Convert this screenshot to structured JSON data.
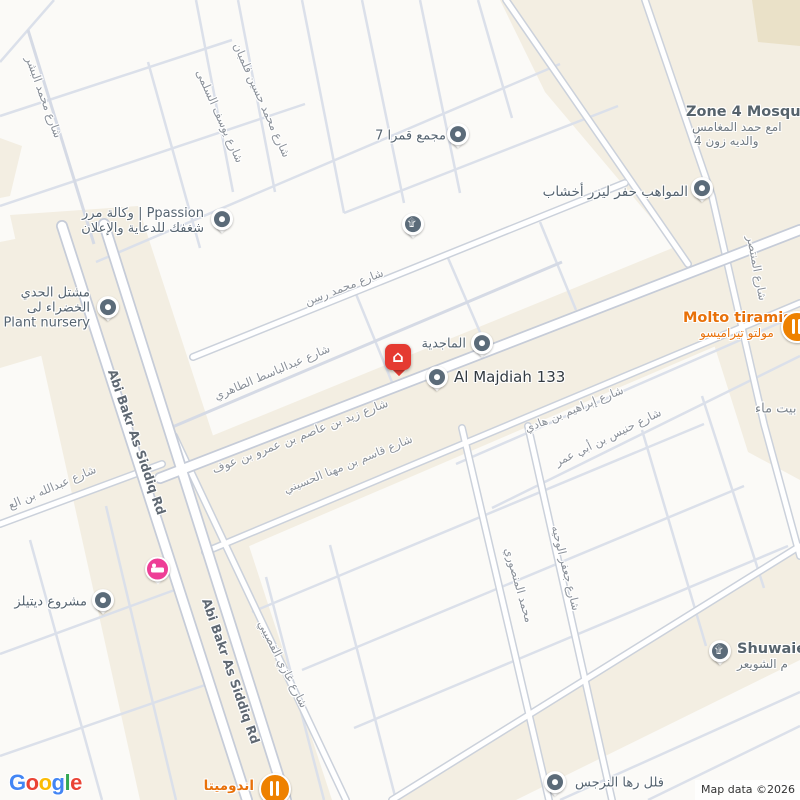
{
  "attribution": "Map data ©2026",
  "logo": {
    "g1": "G",
    "o1": "o",
    "o2": "o",
    "g2": "g",
    "l1": "l",
    "e1": "e"
  },
  "marker": {
    "house_glyph": "⌂"
  },
  "icons": {
    "mosque_glyph": "۩",
    "poi_pin": "gray-teardrop",
    "hotel_pin": "pink-bed",
    "restaurant_pin": "orange-fork-knife"
  },
  "colors": {
    "commercial_area": "#f3eee2",
    "block": "#ffffff",
    "road_casing": "#c6ccd8",
    "minor_street": "#dbe0ea",
    "poi_orange": "#e8710a",
    "marker_red": "#e53a31",
    "hotel_pink": "#ee3e96",
    "pin_slate": "#5b6b79",
    "logo_blue": "#4285F4",
    "logo_red": "#EA4335",
    "logo_yellow": "#FBBC05",
    "logo_green": "#34A853"
  },
  "streets": [
    {
      "name": "شارع محمد البشر"
    },
    {
      "name": "شارع يوسف السلمى"
    },
    {
      "name": "شارع محمد حسين فلمبان"
    },
    {
      "name": "شارع محمد رسن"
    },
    {
      "name": "شارع عبدالباسط الطاهري"
    },
    {
      "name": "شارع زيد بن عاصم بن عمرو بن عوف"
    },
    {
      "name": "شارع قاسم بن مهنا الحسيني"
    },
    {
      "name": "شارع إبراهيم بن هادي"
    },
    {
      "name": "شارع حنيس بن أبي عمر"
    },
    {
      "name": "Abi Bakr As Siddiq Rd"
    },
    {
      "name": "Abi Bakr As Siddiq Rd"
    },
    {
      "name": "شارع غازي القصيبي"
    },
    {
      "name": "شارع عبدالله بن الع"
    },
    {
      "name": "محمد المنصوري"
    },
    {
      "name": "شارع جعفر الوحيه"
    },
    {
      "name": "شارع المنتصر"
    }
  ],
  "pois": {
    "qamra": {
      "label": "مجمع قمرا 7"
    },
    "ppassion": {
      "line1": "وكالة مرر | Ppassion",
      "line2": "شغفك للدعاية والإعلان"
    },
    "nursery": {
      "line1": "مشتل الحدي",
      "line2": "الخضراء لى",
      "line3": "Plant nursery"
    },
    "mawahib": {
      "label": "المواهب حفر ليزر أخشاب"
    },
    "zone4": {
      "line1": "Zone 4 Mosqu",
      "line2": "امع حمد المغامس",
      "line3": "والديه زون 4"
    },
    "molto": {
      "line1": "Molto tiramisu",
      "line2": "مولتو تيراميسو"
    },
    "majdia": {
      "label": "الماجدية"
    },
    "almajdiah133": {
      "label": "Al Majdiah 133"
    },
    "details": {
      "label": "مشروع ديتيلز"
    },
    "indomita": {
      "label": "اندوميتا"
    },
    "narjis": {
      "label": "فلل رها النرجس"
    },
    "shuwaier": {
      "line1": "Shuwaie",
      "line2": "م الشويعر"
    },
    "baytmaa": {
      "label": "بيت ماء"
    }
  }
}
